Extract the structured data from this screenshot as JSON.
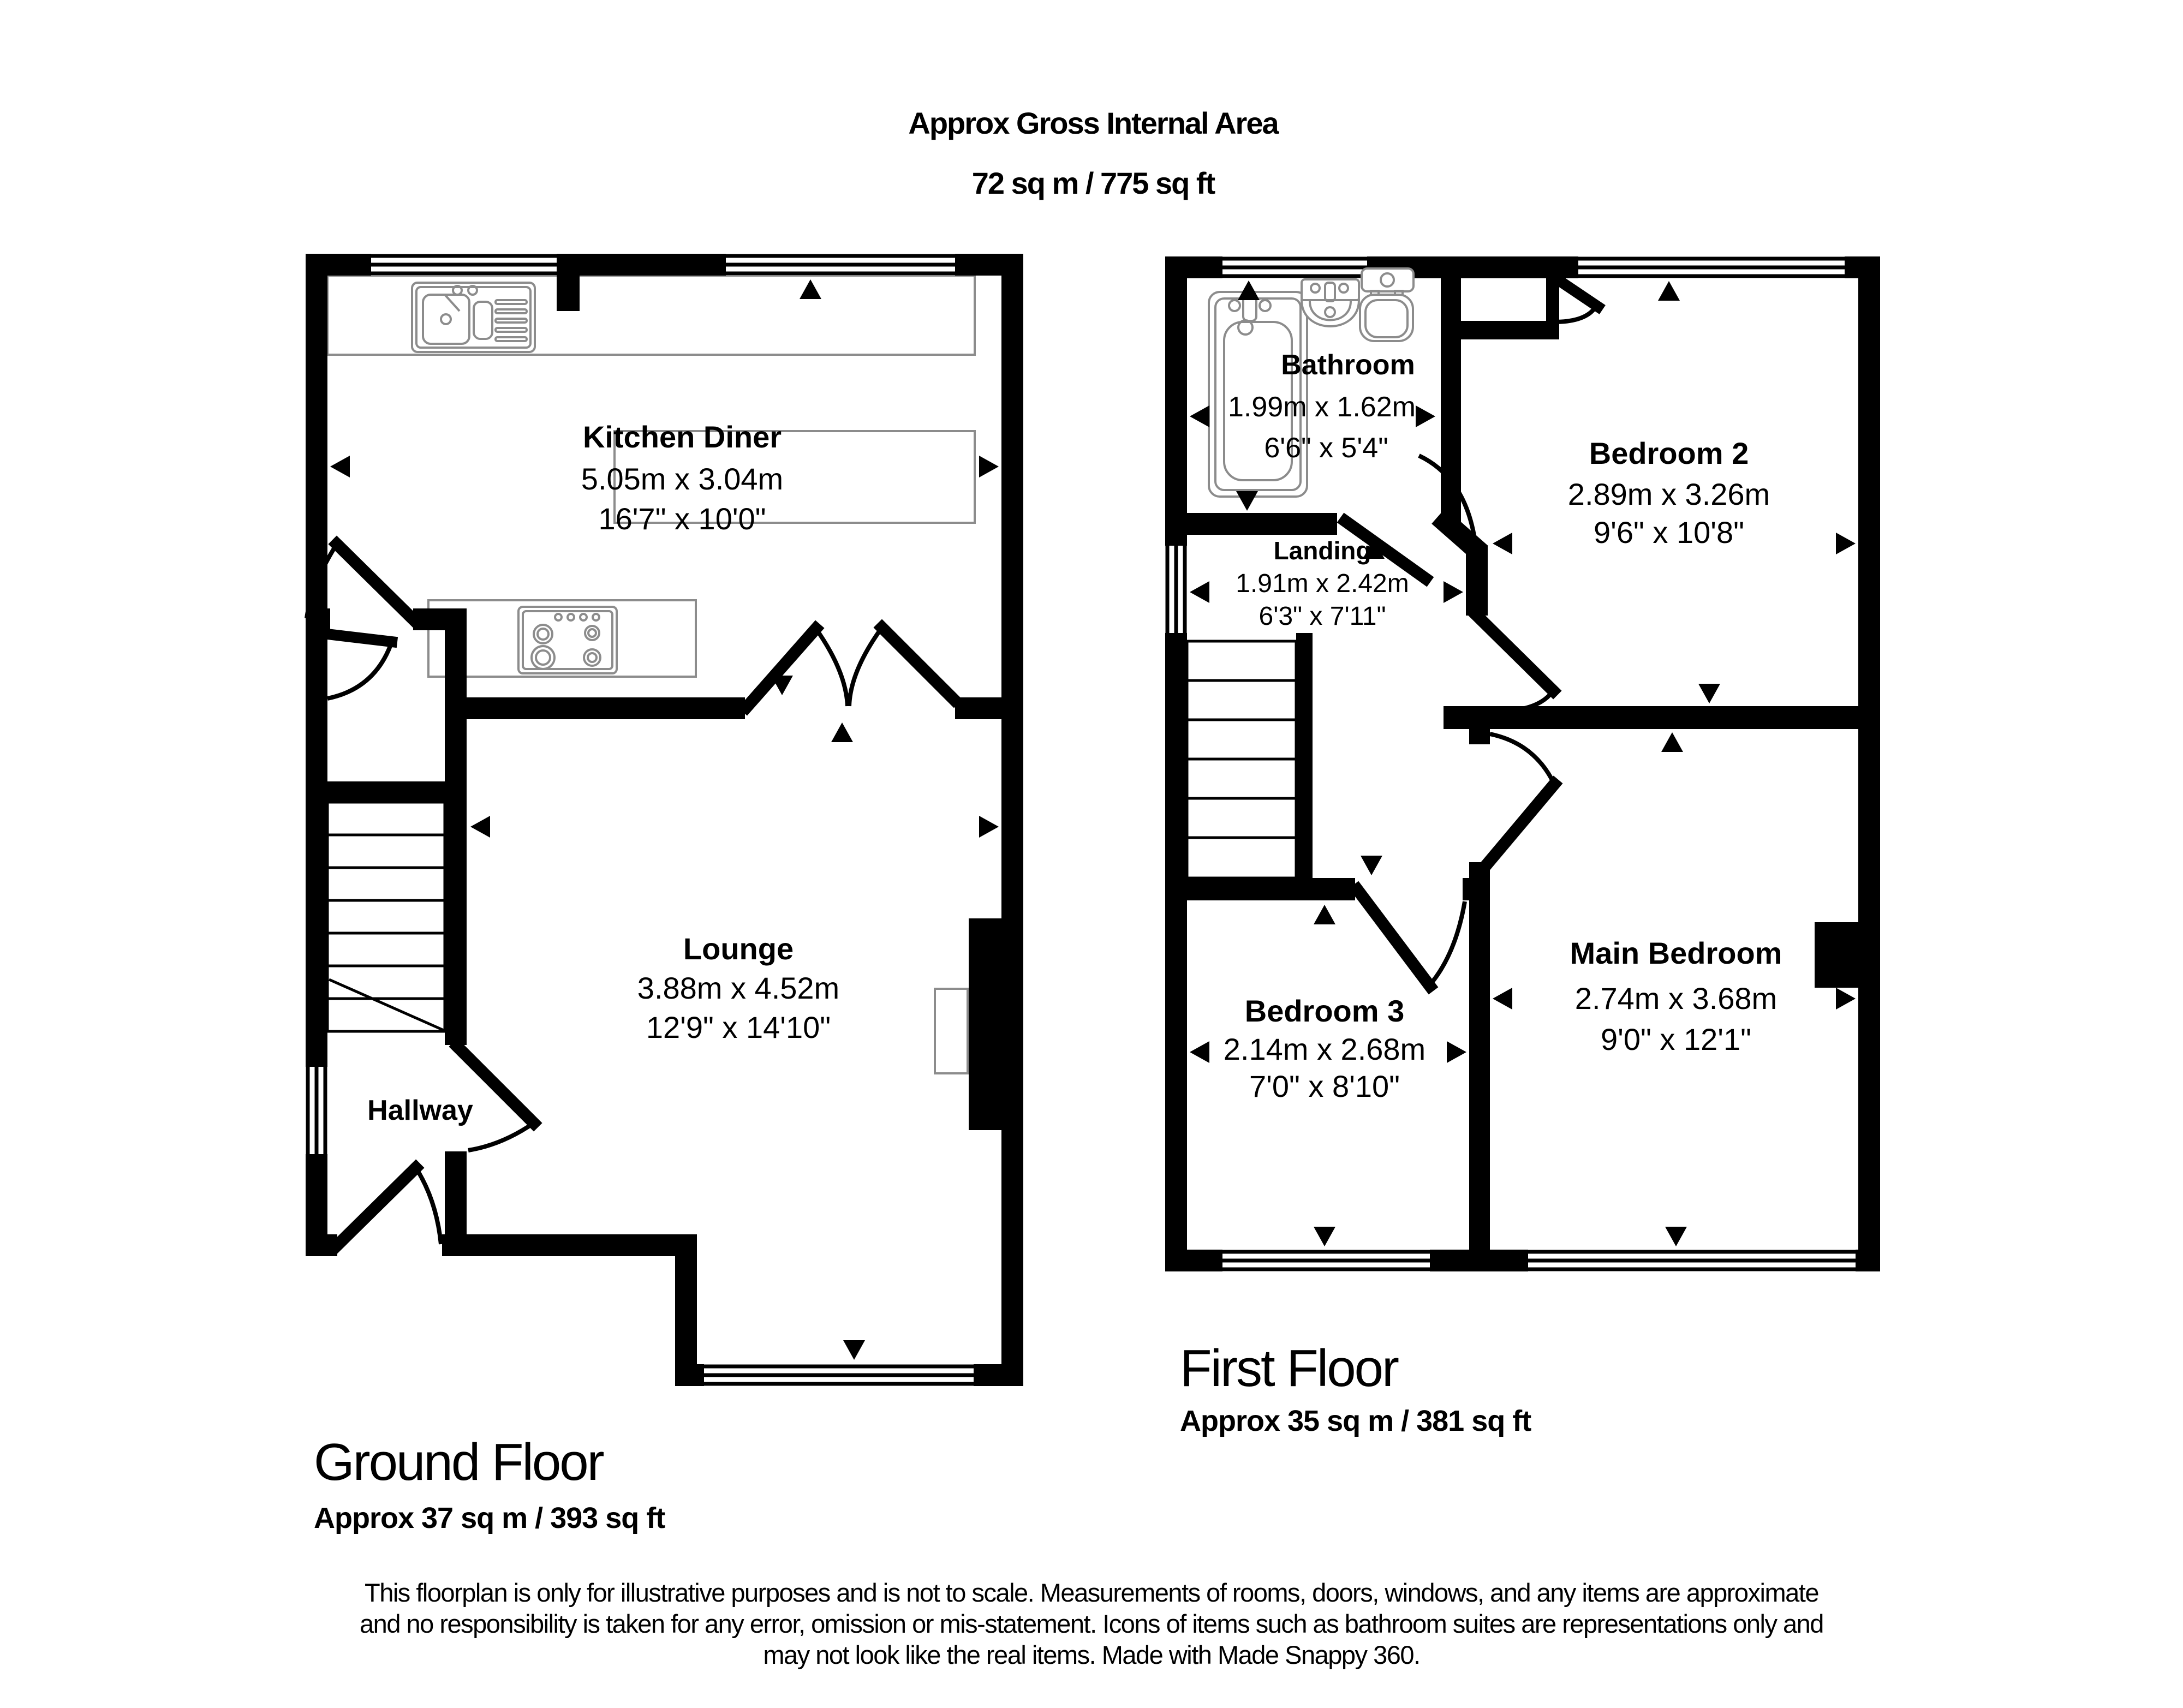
{
  "header": {
    "title": "Approx Gross Internal Area",
    "area": "72 sq m / 775 sq ft"
  },
  "ground": {
    "caption": "Ground Floor",
    "area": "Approx 37 sq m / 393 sq ft",
    "rooms": {
      "kitchen": {
        "name": "Kitchen Diner",
        "metric": "5.05m x 3.04m",
        "imperial": "16'7\" x 10'0\""
      },
      "lounge": {
        "name": "Lounge",
        "metric": "3.88m x 4.52m",
        "imperial": "12'9\" x 14'10\""
      },
      "hallway": {
        "name": "Hallway"
      }
    }
  },
  "first": {
    "caption": "First Floor",
    "area": "Approx 35 sq m / 381 sq ft",
    "rooms": {
      "bathroom": {
        "name": "Bathroom",
        "metric": "1.99m x 1.62m",
        "imperial": "6'6\" x 5'4\""
      },
      "landing": {
        "name": "Landing",
        "metric": "1.91m x 2.42m",
        "imperial": "6'3\" x 7'11\""
      },
      "bedroom2": {
        "name": "Bedroom 2",
        "metric": "2.89m x 3.26m",
        "imperial": "9'6\" x 10'8\""
      },
      "bedroom3": {
        "name": "Bedroom 3",
        "metric": "2.14m x 2.68m",
        "imperial": "7'0\" x 8'10\""
      },
      "main_bedroom": {
        "name": "Main Bedroom",
        "metric": "2.74m x 3.68m",
        "imperial": "9'0\" x 12'1\""
      }
    }
  },
  "disclaimer": {
    "line1": "This floorplan is only for illustrative purposes and is not to scale. Measurements of rooms, doors, windows, and any items are approximate",
    "line2": "and no responsibility is taken for any error, omission or mis-statement. Icons of items such as bathroom suites are representations only and",
    "line3": "may not look like the real items. Made with Made Snappy 360."
  },
  "colors": {
    "walls": "#000000",
    "fixtures": "#8c8c8c",
    "background": "#ffffff"
  }
}
